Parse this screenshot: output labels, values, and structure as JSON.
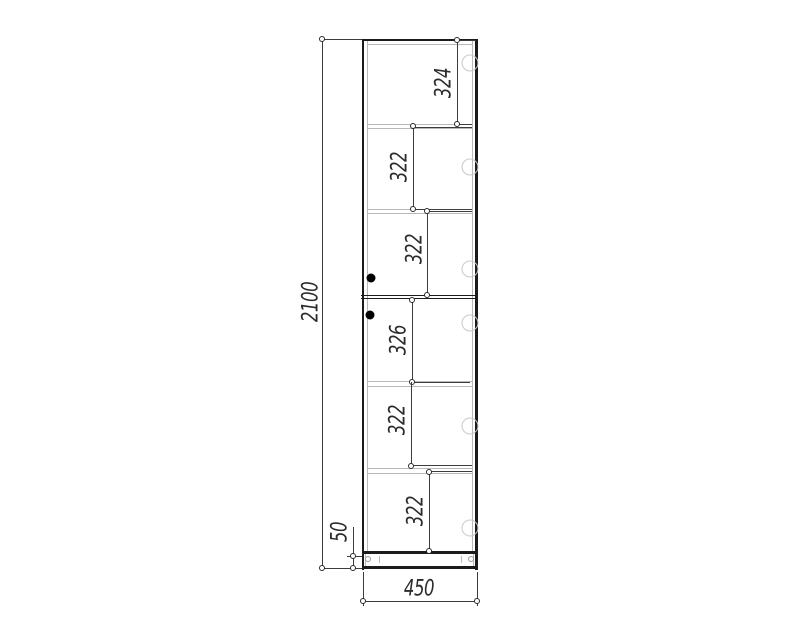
{
  "drawing": {
    "kind": "cabinet front elevation technical drawing",
    "overall": {
      "height": "2100",
      "width": "450",
      "plinth_height": "50"
    },
    "sections": [
      {
        "label": "324"
      },
      {
        "label": "322"
      },
      {
        "label": "322"
      },
      {
        "label": "326"
      },
      {
        "label": "322"
      },
      {
        "label": "322"
      }
    ],
    "colors": {
      "background": "#ffffff",
      "cabinet_outline": "#1b1b1b",
      "panel_lines": "#b9b9b9",
      "dimension_lines": "#3c3c3c",
      "text": "#2b2b2b",
      "hinge_circles": "#c9c9c9",
      "knob": "#000000"
    }
  }
}
